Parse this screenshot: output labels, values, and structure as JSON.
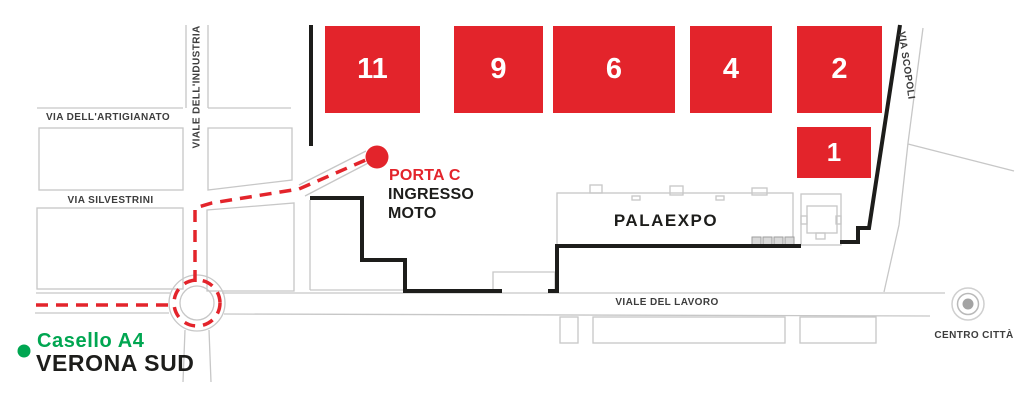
{
  "map": {
    "title_context": "fairground access map",
    "halls": [
      {
        "number": "11"
      },
      {
        "number": "9"
      },
      {
        "number": "6"
      },
      {
        "number": "4"
      },
      {
        "number": "2"
      },
      {
        "number": "1"
      }
    ],
    "streets": {
      "industria": "VIALE DELL'INDUSTRIA",
      "artigianato": "VIA DELL'ARTIGIANATO",
      "silvestrini": "VIA SILVESTRINI",
      "lavoro": "VIALE DEL LAVORO",
      "scopoli": "VIA SCOPOLI"
    },
    "buildings": {
      "palaexpo": "PALAEXPO"
    },
    "entrance": {
      "gate": "PORTA C",
      "line1": "INGRESSO",
      "line2": "MOTO"
    },
    "origin": {
      "line1": "Casello A4",
      "line2": "VERONA SUD"
    },
    "destination": {
      "centro": "CENTRO CITTÀ"
    },
    "icons": {
      "gate_marker": "red-dot-icon",
      "origin_marker": "green-dot-icon",
      "centro_marker": "bullseye-icon",
      "route_style": "red-dashed-line",
      "roundabout": "roundabout-circle"
    },
    "colors": {
      "hall_red": "#e3242b",
      "route_red": "#e3242b",
      "origin_green": "#00a651",
      "boundary_black": "#1d1d1b",
      "road_gray": "#c7c7c7",
      "square_fill_gray": "#d9d9d9",
      "label_gray": "#3d3d3d"
    }
  }
}
